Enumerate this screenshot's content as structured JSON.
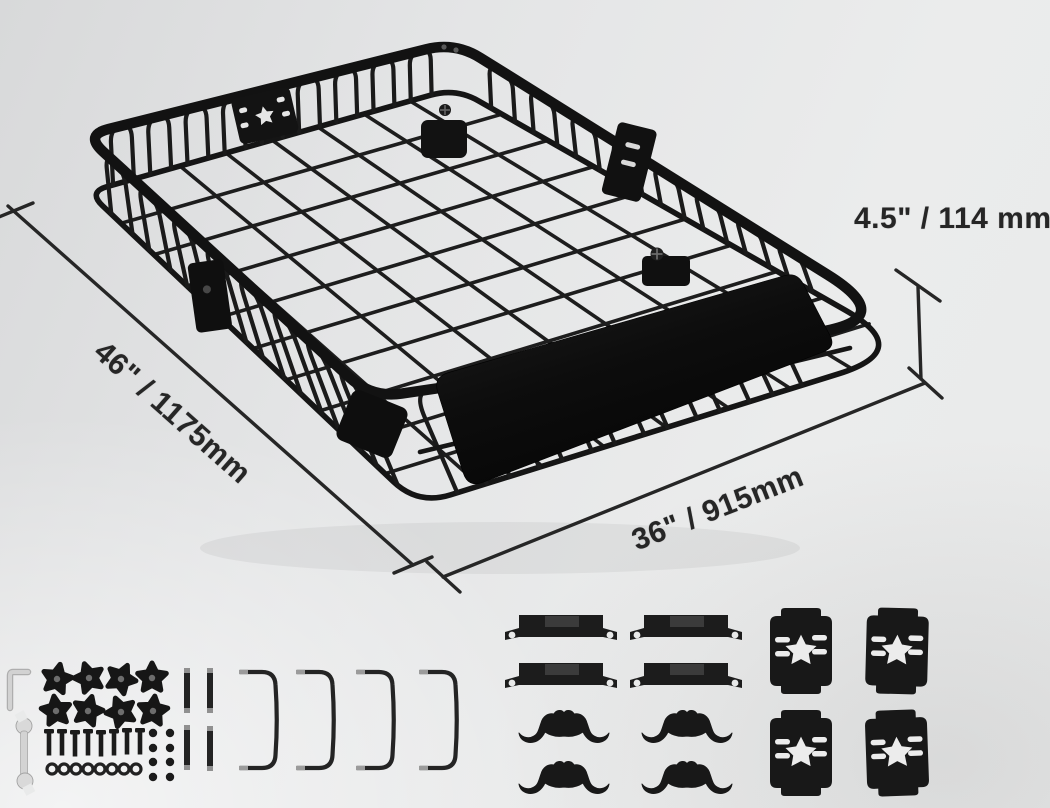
{
  "title": "roof rack cargo basket dimension diagram",
  "dimensions": {
    "length_label": "46\" / 1175mm",
    "width_label": "36\" / 915mm",
    "height_label": "4.5\" / 114 mm"
  },
  "colors": {
    "product": "#141414",
    "annotation": "#262626",
    "background": "#e6e7e8",
    "hardware_metal": "#d6d6d6"
  },
  "hardware_groups": [
    {
      "name": "hex-key",
      "count": 1
    },
    {
      "name": "open-end-wrench",
      "count": 1
    },
    {
      "name": "star-knobs",
      "count": 8
    },
    {
      "name": "bolts",
      "count": 8
    },
    {
      "name": "washers",
      "count": 8
    },
    {
      "name": "nuts",
      "count": 8
    },
    {
      "name": "threaded-rods",
      "count": 4
    },
    {
      "name": "u-brackets",
      "count": 4
    },
    {
      "name": "strap-brackets",
      "count": 4
    },
    {
      "name": "ribbed-clamps",
      "count": 4
    },
    {
      "name": "star-mounting-plates",
      "count": 4
    }
  ]
}
